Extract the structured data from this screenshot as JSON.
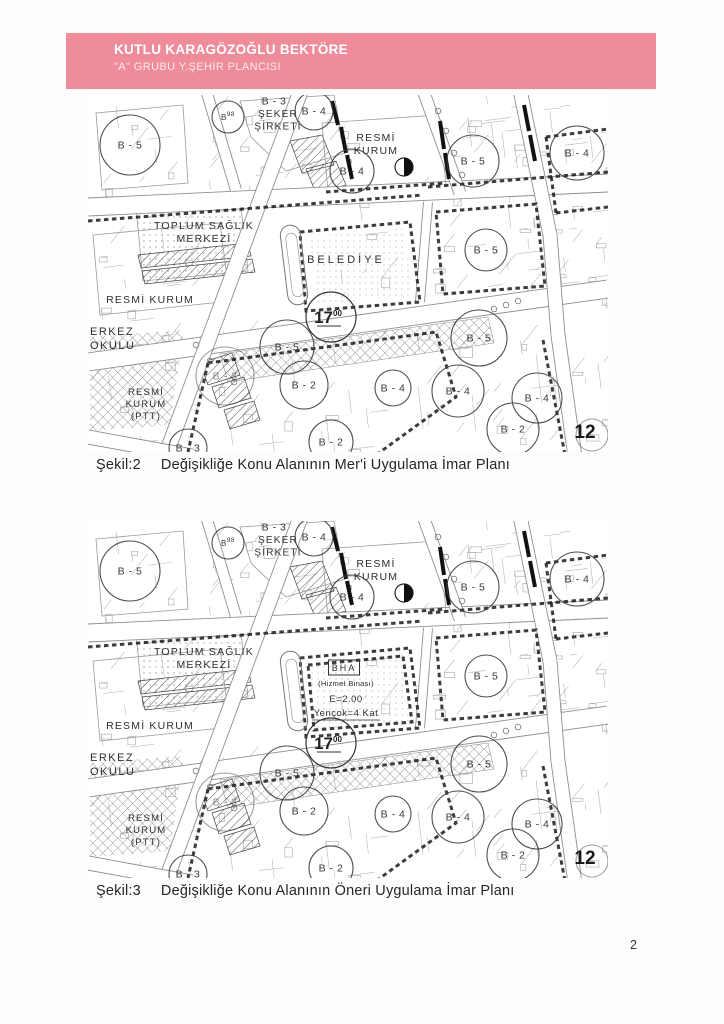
{
  "header": {
    "name": "KUTLU KARAGÖZOĞLU BEKTÖRE",
    "title": "\"A\" GRUBU  Y.ŞEHİR PLANCISI",
    "bg_color": "#ee8c9c"
  },
  "page_number": "2",
  "figures": [
    {
      "caption_label": "Şekil:2",
      "caption_text": "Değişikliğe Konu Alanının Mer'i Uygulama İmar Planı",
      "variant": "meri",
      "zones": [
        {
          "label": "B - 5",
          "x": 42,
          "y": 50,
          "r": 30
        },
        {
          "label": "B",
          "sup": "98",
          "x": 140,
          "y": 22,
          "r": 16
        },
        {
          "label": "B - 3",
          "x": 186,
          "y": 6,
          "r": 0
        },
        {
          "label": "B - 4",
          "x": 226,
          "y": 16,
          "r": 19
        },
        {
          "label": "B - 4",
          "topnum": "3",
          "x": 264,
          "y": 76,
          "r": 22
        },
        {
          "label": "B - 5",
          "x": 385,
          "y": 66,
          "r": 26
        },
        {
          "label": "B - 4",
          "x": 489,
          "y": 58,
          "r": 27
        },
        {
          "label": "B - 5",
          "x": 398,
          "y": 155,
          "r": 21
        },
        {
          "label": "B - 5",
          "x": 199,
          "y": 252,
          "r": 27
        },
        {
          "label": "B - 3",
          "x": 137,
          "y": 281,
          "r": 29,
          "faint": true
        },
        {
          "label": "B - 2",
          "x": 216,
          "y": 290,
          "r": 24
        },
        {
          "label": "B - 5",
          "x": 391,
          "y": 243,
          "r": 28
        },
        {
          "label": "B - 4",
          "x": 305,
          "y": 293,
          "r": 18
        },
        {
          "label": "B - 4",
          "x": 370,
          "y": 296,
          "r": 26
        },
        {
          "label": "B - 4",
          "x": 449,
          "y": 303,
          "r": 25
        },
        {
          "label": "B - 2",
          "x": 425,
          "y": 334,
          "r": 26
        },
        {
          "label": "B - 2",
          "x": 243,
          "y": 347,
          "r": 22
        },
        {
          "label": "B - 3",
          "x": 100,
          "y": 353,
          "r": 19
        }
      ],
      "special_circle": {
        "label": "17",
        "sup": "00",
        "x": 243,
        "y": 222,
        "r": 25
      },
      "corner_number": {
        "text": "12",
        "x": 497,
        "y": 336
      },
      "places": [
        {
          "lines": [
            "ŞEKER",
            "ŞİRKETİ"
          ],
          "x": 190,
          "y": 22,
          "size": 10
        },
        {
          "lines": [
            "RESMİ",
            "KURUM"
          ],
          "x": 288,
          "y": 46,
          "size": 10.5
        },
        {
          "lines": [
            "TOPLUM SAĞLIK",
            "MERKEZİ"
          ],
          "x": 116,
          "y": 134,
          "size": 10.5
        },
        {
          "lines": [
            "BELEDİYE"
          ],
          "x": 258,
          "y": 168,
          "size": 11,
          "ls": 3
        },
        {
          "lines": [
            "RESMİ KURUM"
          ],
          "x": 62,
          "y": 208,
          "size": 10.5
        },
        {
          "lines": [
            "ERKEZ",
            "OKULU"
          ],
          "x": 2,
          "y": 240,
          "size": 11,
          "anchor": "start",
          "ls": 1.5
        },
        {
          "lines": [
            "RESMİ",
            "KURUM",
            "(PTT)"
          ],
          "x": 58,
          "y": 300,
          "size": 9.5
        }
      ]
    },
    {
      "caption_label": "Şekil:3",
      "caption_text": "Değişikliğe Konu Alanının Öneri  Uygulama İmar Planı",
      "variant": "oneri",
      "zones": [
        {
          "label": "B - 5",
          "x": 42,
          "y": 50,
          "r": 30
        },
        {
          "label": "B",
          "sup": "98",
          "x": 140,
          "y": 22,
          "r": 16
        },
        {
          "label": "B - 3",
          "x": 186,
          "y": 6,
          "r": 0
        },
        {
          "label": "B - 4",
          "x": 226,
          "y": 16,
          "r": 19
        },
        {
          "label": "B - 4",
          "topnum": "3",
          "x": 264,
          "y": 76,
          "r": 22
        },
        {
          "label": "B - 5",
          "x": 385,
          "y": 66,
          "r": 26
        },
        {
          "label": "B - 4",
          "x": 489,
          "y": 58,
          "r": 27
        },
        {
          "label": "B - 5",
          "x": 398,
          "y": 155,
          "r": 21
        },
        {
          "label": "B - 5",
          "x": 199,
          "y": 252,
          "r": 27
        },
        {
          "label": "B - 3",
          "x": 137,
          "y": 281,
          "r": 29,
          "faint": true
        },
        {
          "label": "B - 2",
          "x": 216,
          "y": 290,
          "r": 24
        },
        {
          "label": "B - 5",
          "x": 391,
          "y": 243,
          "r": 28
        },
        {
          "label": "B - 4",
          "x": 305,
          "y": 293,
          "r": 18
        },
        {
          "label": "B - 4",
          "x": 370,
          "y": 296,
          "r": 26
        },
        {
          "label": "B - 4",
          "x": 449,
          "y": 303,
          "r": 25
        },
        {
          "label": "B - 2",
          "x": 425,
          "y": 334,
          "r": 26
        },
        {
          "label": "B - 2",
          "x": 243,
          "y": 347,
          "r": 22
        },
        {
          "label": "B - 3",
          "x": 100,
          "y": 353,
          "r": 19
        }
      ],
      "special_circle": {
        "label": "17",
        "sup": "00",
        "x": 243,
        "y": 222,
        "r": 25
      },
      "corner_number": {
        "text": "12",
        "x": 497,
        "y": 336
      },
      "places": [
        {
          "lines": [
            "ŞEKER",
            "ŞİRKETİ"
          ],
          "x": 190,
          "y": 22,
          "size": 10
        },
        {
          "lines": [
            "RESMİ",
            "KURUM"
          ],
          "x": 288,
          "y": 46,
          "size": 10.5
        },
        {
          "lines": [
            "TOPLUM SAĞLIK",
            "MERKEZİ"
          ],
          "x": 116,
          "y": 134,
          "size": 10.5
        },
        {
          "lines": [
            "BHA"
          ],
          "x": 256,
          "y": 150,
          "size": 9,
          "boxed": true,
          "ls": 2
        },
        {
          "lines": [
            "(Hizmet Binası)"
          ],
          "x": 258,
          "y": 165,
          "size": 7.5,
          "ls": 0.3
        },
        {
          "lines": [
            "E=2.00"
          ],
          "x": 258,
          "y": 181,
          "size": 9.5,
          "ls": 0.5
        },
        {
          "lines": [
            "Yençok=4 Kat"
          ],
          "x": 258,
          "y": 195,
          "size": 9.5,
          "ls": 0.5,
          "underline": true
        },
        {
          "lines": [
            "RESMİ KURUM"
          ],
          "x": 62,
          "y": 208,
          "size": 10.5
        },
        {
          "lines": [
            "ERKEZ",
            "OKULU"
          ],
          "x": 2,
          "y": 240,
          "size": 11,
          "anchor": "start",
          "ls": 1.5
        },
        {
          "lines": [
            "RESMİ",
            "KURUM",
            "(PTT)"
          ],
          "x": 58,
          "y": 300,
          "size": 9.5
        }
      ]
    }
  ]
}
